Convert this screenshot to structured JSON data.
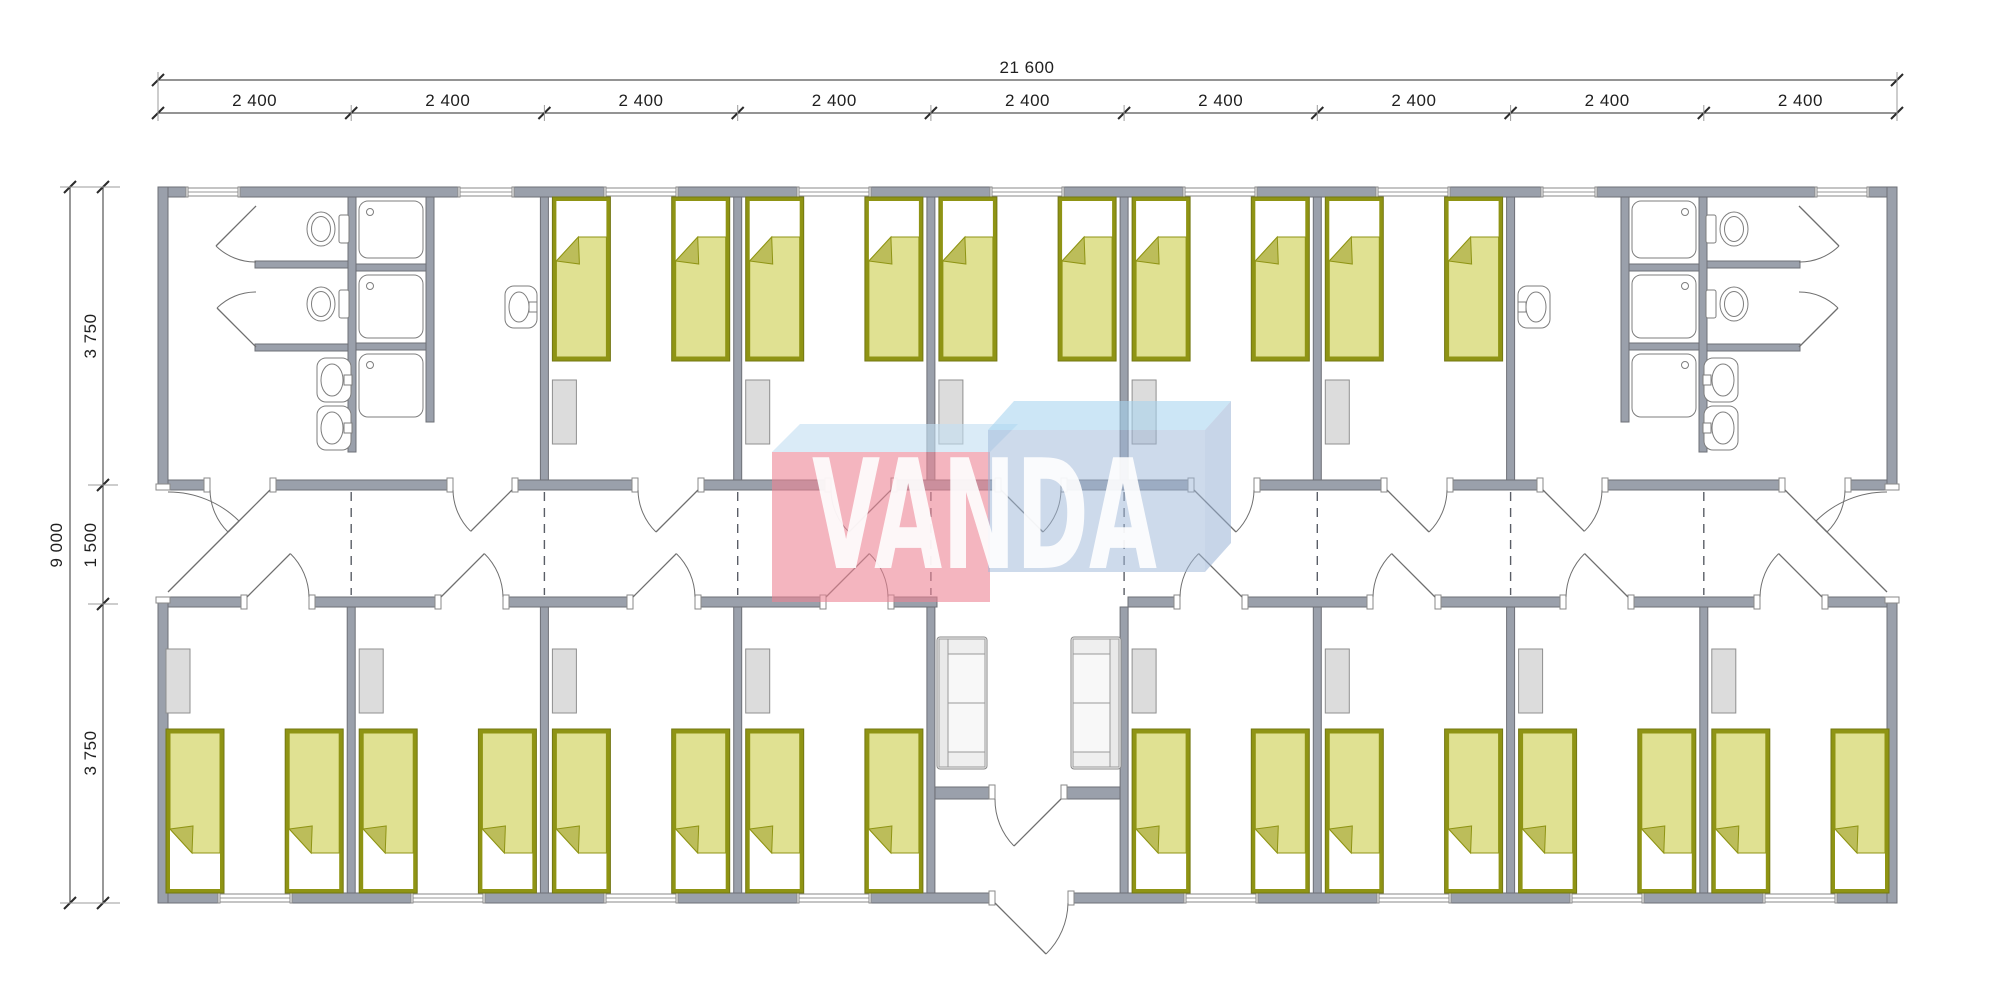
{
  "watermark": {
    "brand": "VANDA"
  },
  "dimensions": {
    "overall_width": "21 600",
    "module_width": "2 400",
    "module_count": 9,
    "overall_depth": "9 000",
    "room_depth_top": "3 750",
    "corridor_width": "1 500",
    "room_depth_bottom": "3 750"
  },
  "building": {
    "type": "modular dormitory floor plan",
    "top_row": [
      {
        "type": "sanitary",
        "position": "left",
        "toilets": 2,
        "showers": 3,
        "sinks": 3,
        "wc_stalls": 2,
        "doors_to_corridor": 2,
        "windows": 2
      },
      {
        "type": "bedroom",
        "beds": 2,
        "wardrobes": 1,
        "windows": 1,
        "doors_to_corridor": 1
      },
      {
        "type": "bedroom",
        "beds": 2,
        "wardrobes": 1,
        "windows": 1,
        "doors_to_corridor": 1
      },
      {
        "type": "bedroom",
        "beds": 2,
        "wardrobes": 1,
        "windows": 1,
        "doors_to_corridor": 1
      },
      {
        "type": "bedroom",
        "beds": 2,
        "wardrobes": 1,
        "windows": 1,
        "doors_to_corridor": 1
      },
      {
        "type": "bedroom",
        "beds": 2,
        "wardrobes": 1,
        "windows": 1,
        "doors_to_corridor": 1
      },
      {
        "type": "sanitary",
        "position": "right",
        "toilets": 2,
        "showers": 3,
        "sinks": 3,
        "wc_stalls": 2,
        "doors_to_corridor": 2,
        "windows": 2
      }
    ],
    "corridor": {
      "exterior_end_doors": 2,
      "module_joint_lines": 8
    },
    "bottom_row": [
      {
        "type": "bedroom",
        "beds": 2
      },
      {
        "type": "bedroom",
        "beds": 2
      },
      {
        "type": "bedroom",
        "beds": 2
      },
      {
        "type": "bedroom",
        "beds": 2
      },
      {
        "type": "entrance-hall",
        "sofas": 2,
        "vestibule_doors": 1,
        "exterior_doors": 1
      },
      {
        "type": "bedroom",
        "beds": 2
      },
      {
        "type": "bedroom",
        "beds": 2
      },
      {
        "type": "bedroom",
        "beds": 2
      },
      {
        "type": "bedroom",
        "beds": 2
      }
    ],
    "total_beds": 26
  },
  "colors": {
    "wall_fill": "#9aa0ab",
    "wall_stroke": "#6e7077",
    "line": "#6f6f6f",
    "bed_frame": "#8f9414",
    "bed_blanket": "#e0e192",
    "bed_fold": "#bcbd5a",
    "furniture_fill": "#dcdcdc",
    "fixture_stroke": "#7e7e7e",
    "dash": "#5a5e66",
    "watermark_red": "#ec8494",
    "watermark_red_top": "#c3dff2",
    "watermark_blue": "#9fb9d9",
    "watermark_blue_top": "#a7d4f0",
    "watermark_blue_side": "#93aed2",
    "watermark_text": "#ffffff"
  }
}
